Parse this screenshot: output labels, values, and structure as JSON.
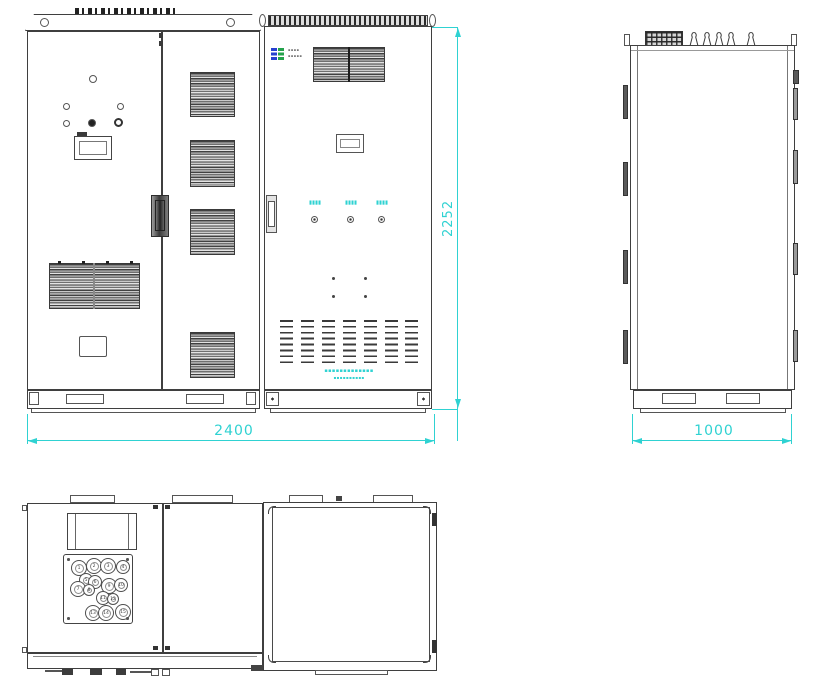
{
  "drawing": {
    "kind": "cabinet-engineering-drawing",
    "views": [
      {
        "id": "front",
        "label": "front view"
      },
      {
        "id": "side",
        "label": "side view"
      },
      {
        "id": "top",
        "label": "top view"
      }
    ],
    "dimensions": {
      "overall_width_mm": "2400",
      "overall_height_mm": "2252",
      "overall_depth_mm": "1000"
    },
    "colors": {
      "line": "#3f3f3f",
      "dimension": "#2fd2d2",
      "logo_blue": "#2640cf",
      "logo_green": "#23a24b"
    },
    "front": {
      "logo_text_lines": [
        "▪▪▪▪",
        "▪▪▪▪▪"
      ],
      "connector_labels": [
        "▮▮▮▮",
        "▮▮▮▮",
        "▮▮▮▮"
      ],
      "company_text_lines": [
        "▪▪▪▪▪▪▪▪▪▪▪▪▪",
        "▪▪▪▪▪▪▪▪▪▪"
      ]
    },
    "top": {
      "glands": [
        {
          "x": 14,
          "y": 12,
          "r": 7,
          "n": "1"
        },
        {
          "x": 29,
          "y": 10,
          "r": 7,
          "n": "2"
        },
        {
          "x": 43,
          "y": 10,
          "r": 7,
          "n": "3"
        },
        {
          "x": 58,
          "y": 11,
          "r": 6,
          "n": "4"
        },
        {
          "x": 21,
          "y": 24,
          "r": 6,
          "n": "5"
        },
        {
          "x": 30,
          "y": 26,
          "r": 6,
          "n": "6"
        },
        {
          "x": 13,
          "y": 33,
          "r": 7,
          "n": "7"
        },
        {
          "x": 24,
          "y": 34,
          "r": 5,
          "n": "8"
        },
        {
          "x": 44,
          "y": 30,
          "r": 7,
          "n": "9"
        },
        {
          "x": 56,
          "y": 29,
          "r": 6,
          "n": "10"
        },
        {
          "x": 38,
          "y": 42,
          "r": 6,
          "n": "11"
        },
        {
          "x": 48,
          "y": 43,
          "r": 5,
          "n": "12"
        },
        {
          "x": 28,
          "y": 57,
          "r": 7,
          "n": "13"
        },
        {
          "x": 41,
          "y": 57,
          "r": 7,
          "n": "14"
        },
        {
          "x": 58,
          "y": 56,
          "r": 7,
          "n": "15"
        }
      ]
    }
  }
}
